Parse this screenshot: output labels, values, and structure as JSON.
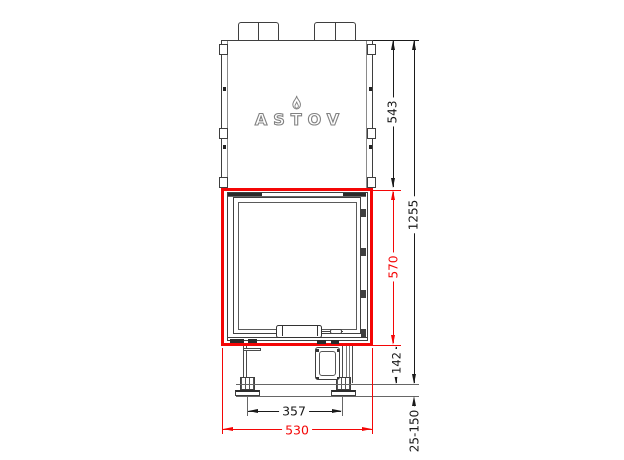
{
  "drawing": {
    "brand_logo": "ASTOV",
    "dimensions": {
      "upper_height": "543",
      "total_height": "1255",
      "door_height": "570",
      "base_height": "142",
      "feet_spacing": "357",
      "overall_width": "530",
      "leg_adjustment_range": "25-150"
    },
    "colors": {
      "accent_red": "#f40606",
      "line_dark": "#3f3f3f",
      "dim_text": "#1a1a1a"
    }
  }
}
